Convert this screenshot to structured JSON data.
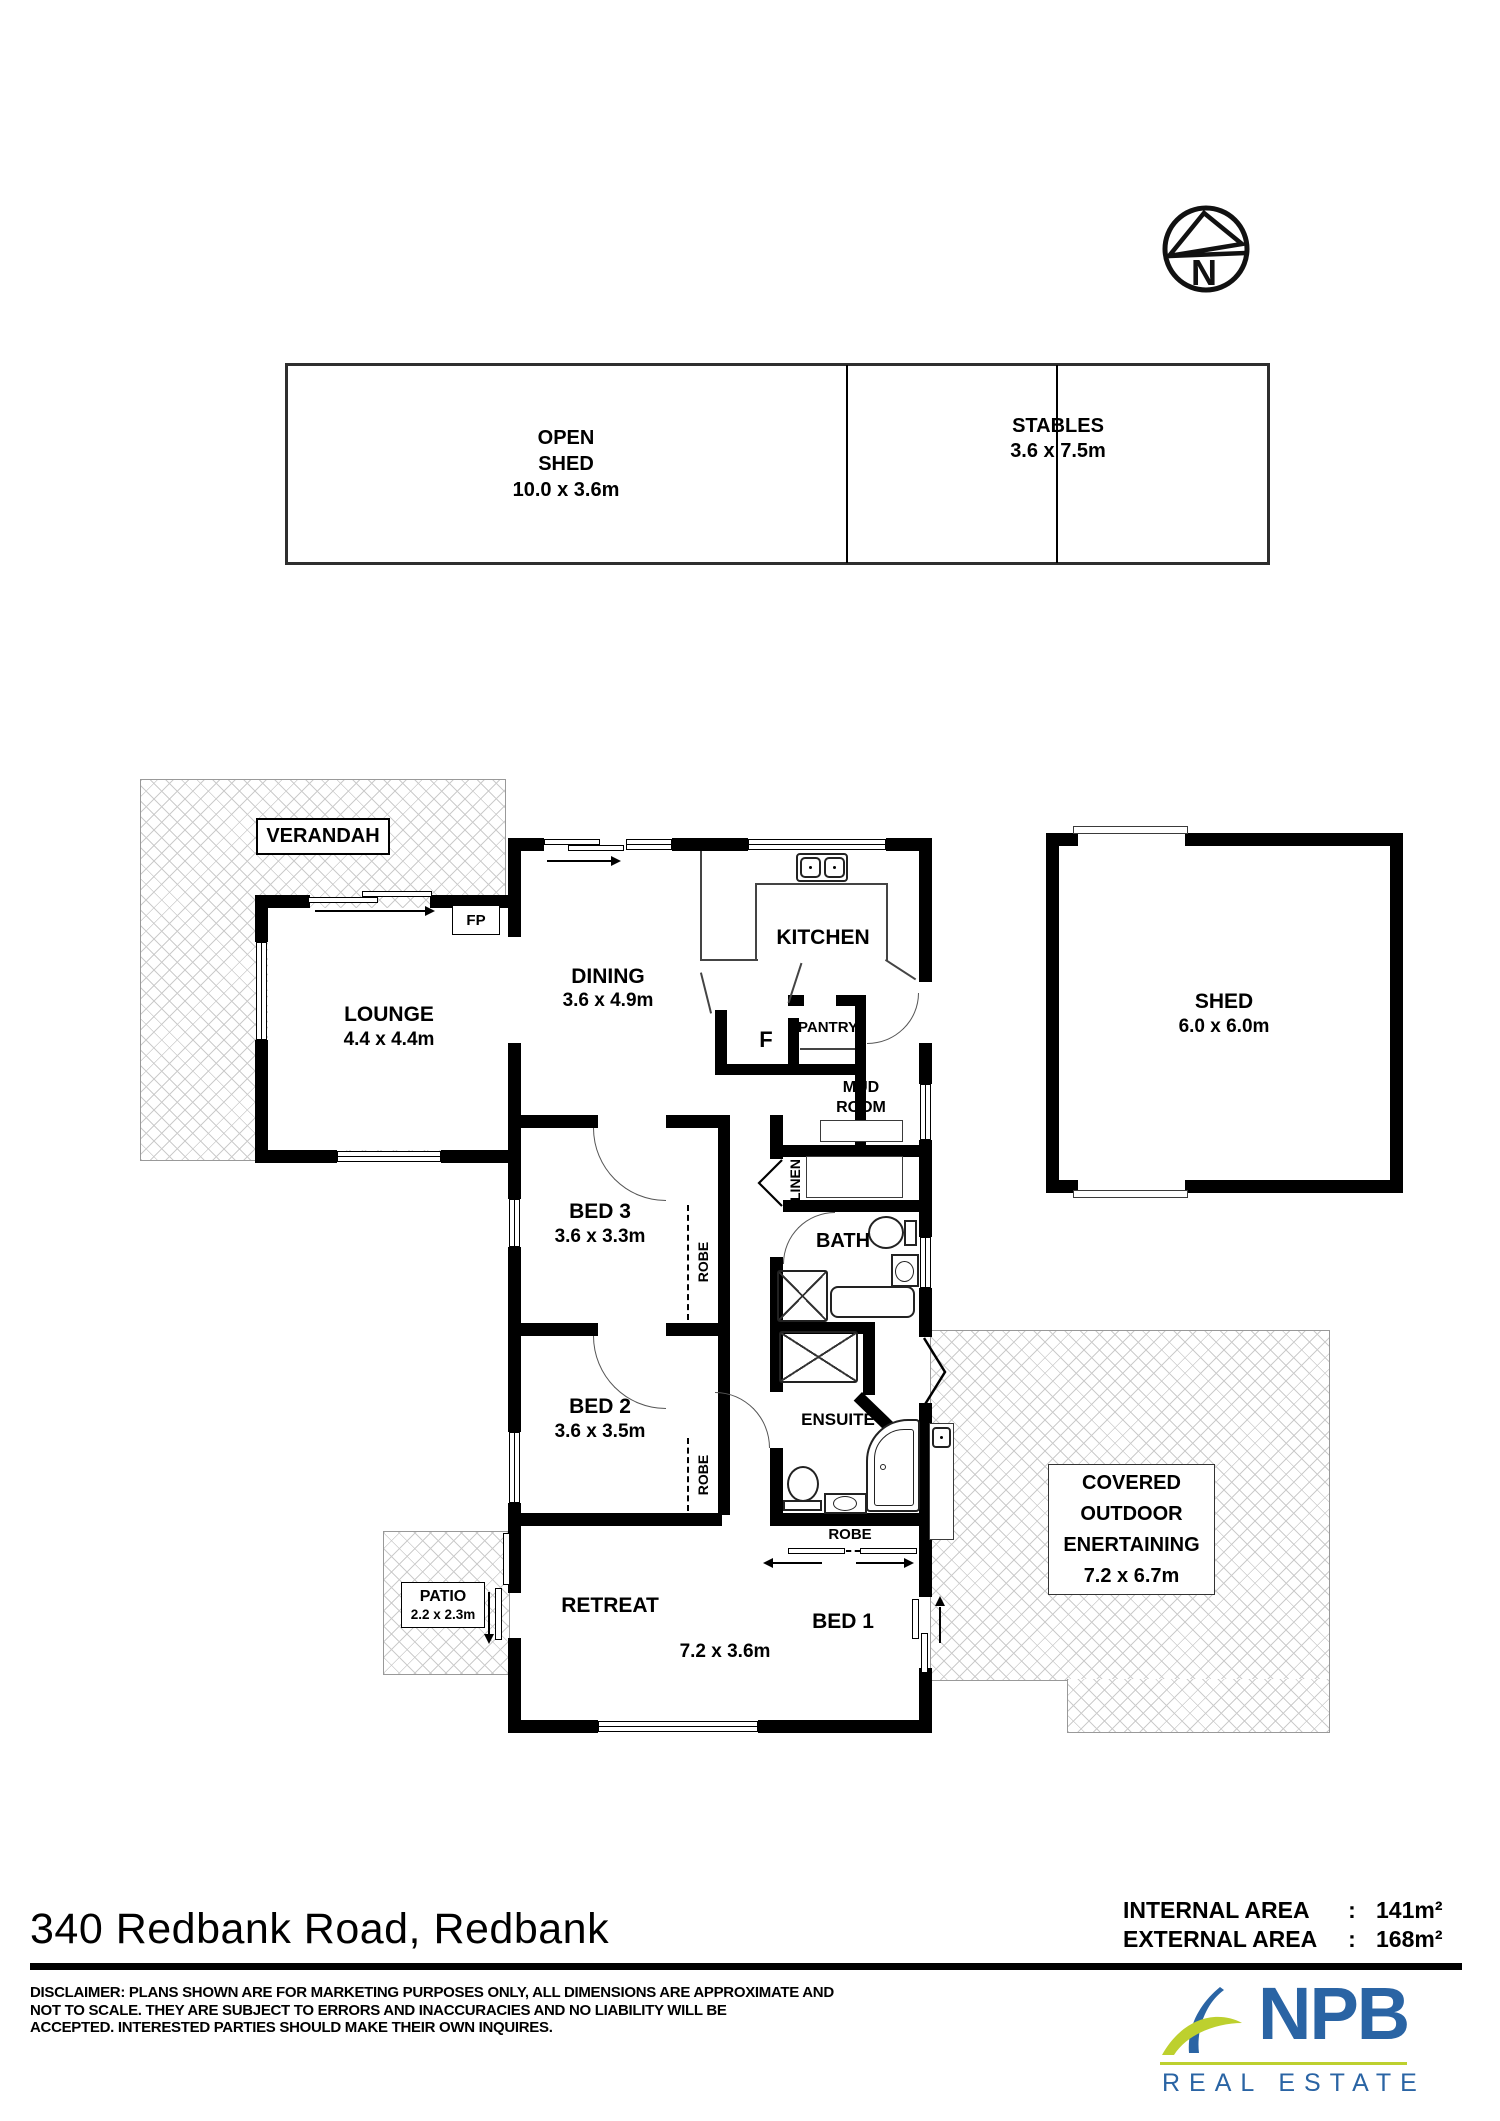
{
  "compass": {
    "letter": "N"
  },
  "outbuildings": {
    "open_shed": {
      "line1": "OPEN",
      "line2": "SHED",
      "dim": "10.0 x 3.6m"
    },
    "stables": {
      "name": "STABLES",
      "dim": "3.6 x 7.5m"
    },
    "shed": {
      "name": "SHED",
      "dim": "6.0 x 6.0m"
    }
  },
  "rooms": {
    "verandah": {
      "name": "VERANDAH"
    },
    "lounge": {
      "name": "LOUNGE",
      "dim": "4.4 x 4.4m"
    },
    "fireplace": {
      "label": "FP"
    },
    "dining": {
      "name": "DINING",
      "dim": "3.6 x 4.9m"
    },
    "kitchen": {
      "name": "KITCHEN"
    },
    "pantry": {
      "name": "PANTRY"
    },
    "fridge": {
      "label": "F"
    },
    "mud_room": {
      "line1": "MUD",
      "line2": "ROOM"
    },
    "linen": {
      "name": "LINEN"
    },
    "bath": {
      "name": "BATH"
    },
    "bed3": {
      "name": "BED 3",
      "dim": "3.6 x 3.3m"
    },
    "robe3": {
      "name": "ROBE"
    },
    "bed2": {
      "name": "BED 2",
      "dim": "3.6 x 3.5m"
    },
    "robe2": {
      "name": "ROBE"
    },
    "ensuite": {
      "name": "ENSUITE"
    },
    "robe1": {
      "name": "ROBE"
    },
    "retreat": {
      "name": "RETREAT",
      "dim": "7.2 x 3.6m"
    },
    "bed1": {
      "name": "BED 1"
    },
    "patio": {
      "name": "PATIO",
      "dim": "2.2 x 2.3m"
    },
    "covered_outdoor": {
      "line1": "COVERED",
      "line2": "OUTDOOR",
      "line3": "ENERTAINING",
      "dim": "7.2 x 6.7m"
    }
  },
  "footer": {
    "title": "340 Redbank Road, Redbank",
    "areas": [
      {
        "label": "INTERNAL AREA",
        "sep": ":",
        "value": "141m²"
      },
      {
        "label": "EXTERNAL AREA",
        "sep": ":",
        "value": "168m²"
      }
    ],
    "disclaimer": {
      "line1": "DISCLAIMER: PLANS SHOWN ARE FOR MARKETING PURPOSES ONLY, ALL DIMENSIONS ARE APPROXIMATE AND",
      "line2": "NOT TO SCALE. THEY ARE SUBJECT TO ERRORS AND INACCURACIES AND NO LIABILITY WILL BE",
      "line3": "ACCEPTED. INTERESTED PARTIES SHOULD MAKE THEIR OWN INQUIRES."
    },
    "logo": {
      "brand": "NPB",
      "tagline": "REAL ESTATE"
    }
  },
  "colors": {
    "brand_blue": "#2a64a4",
    "brand_green": "#bdd02e",
    "wall_black": "#000000"
  }
}
